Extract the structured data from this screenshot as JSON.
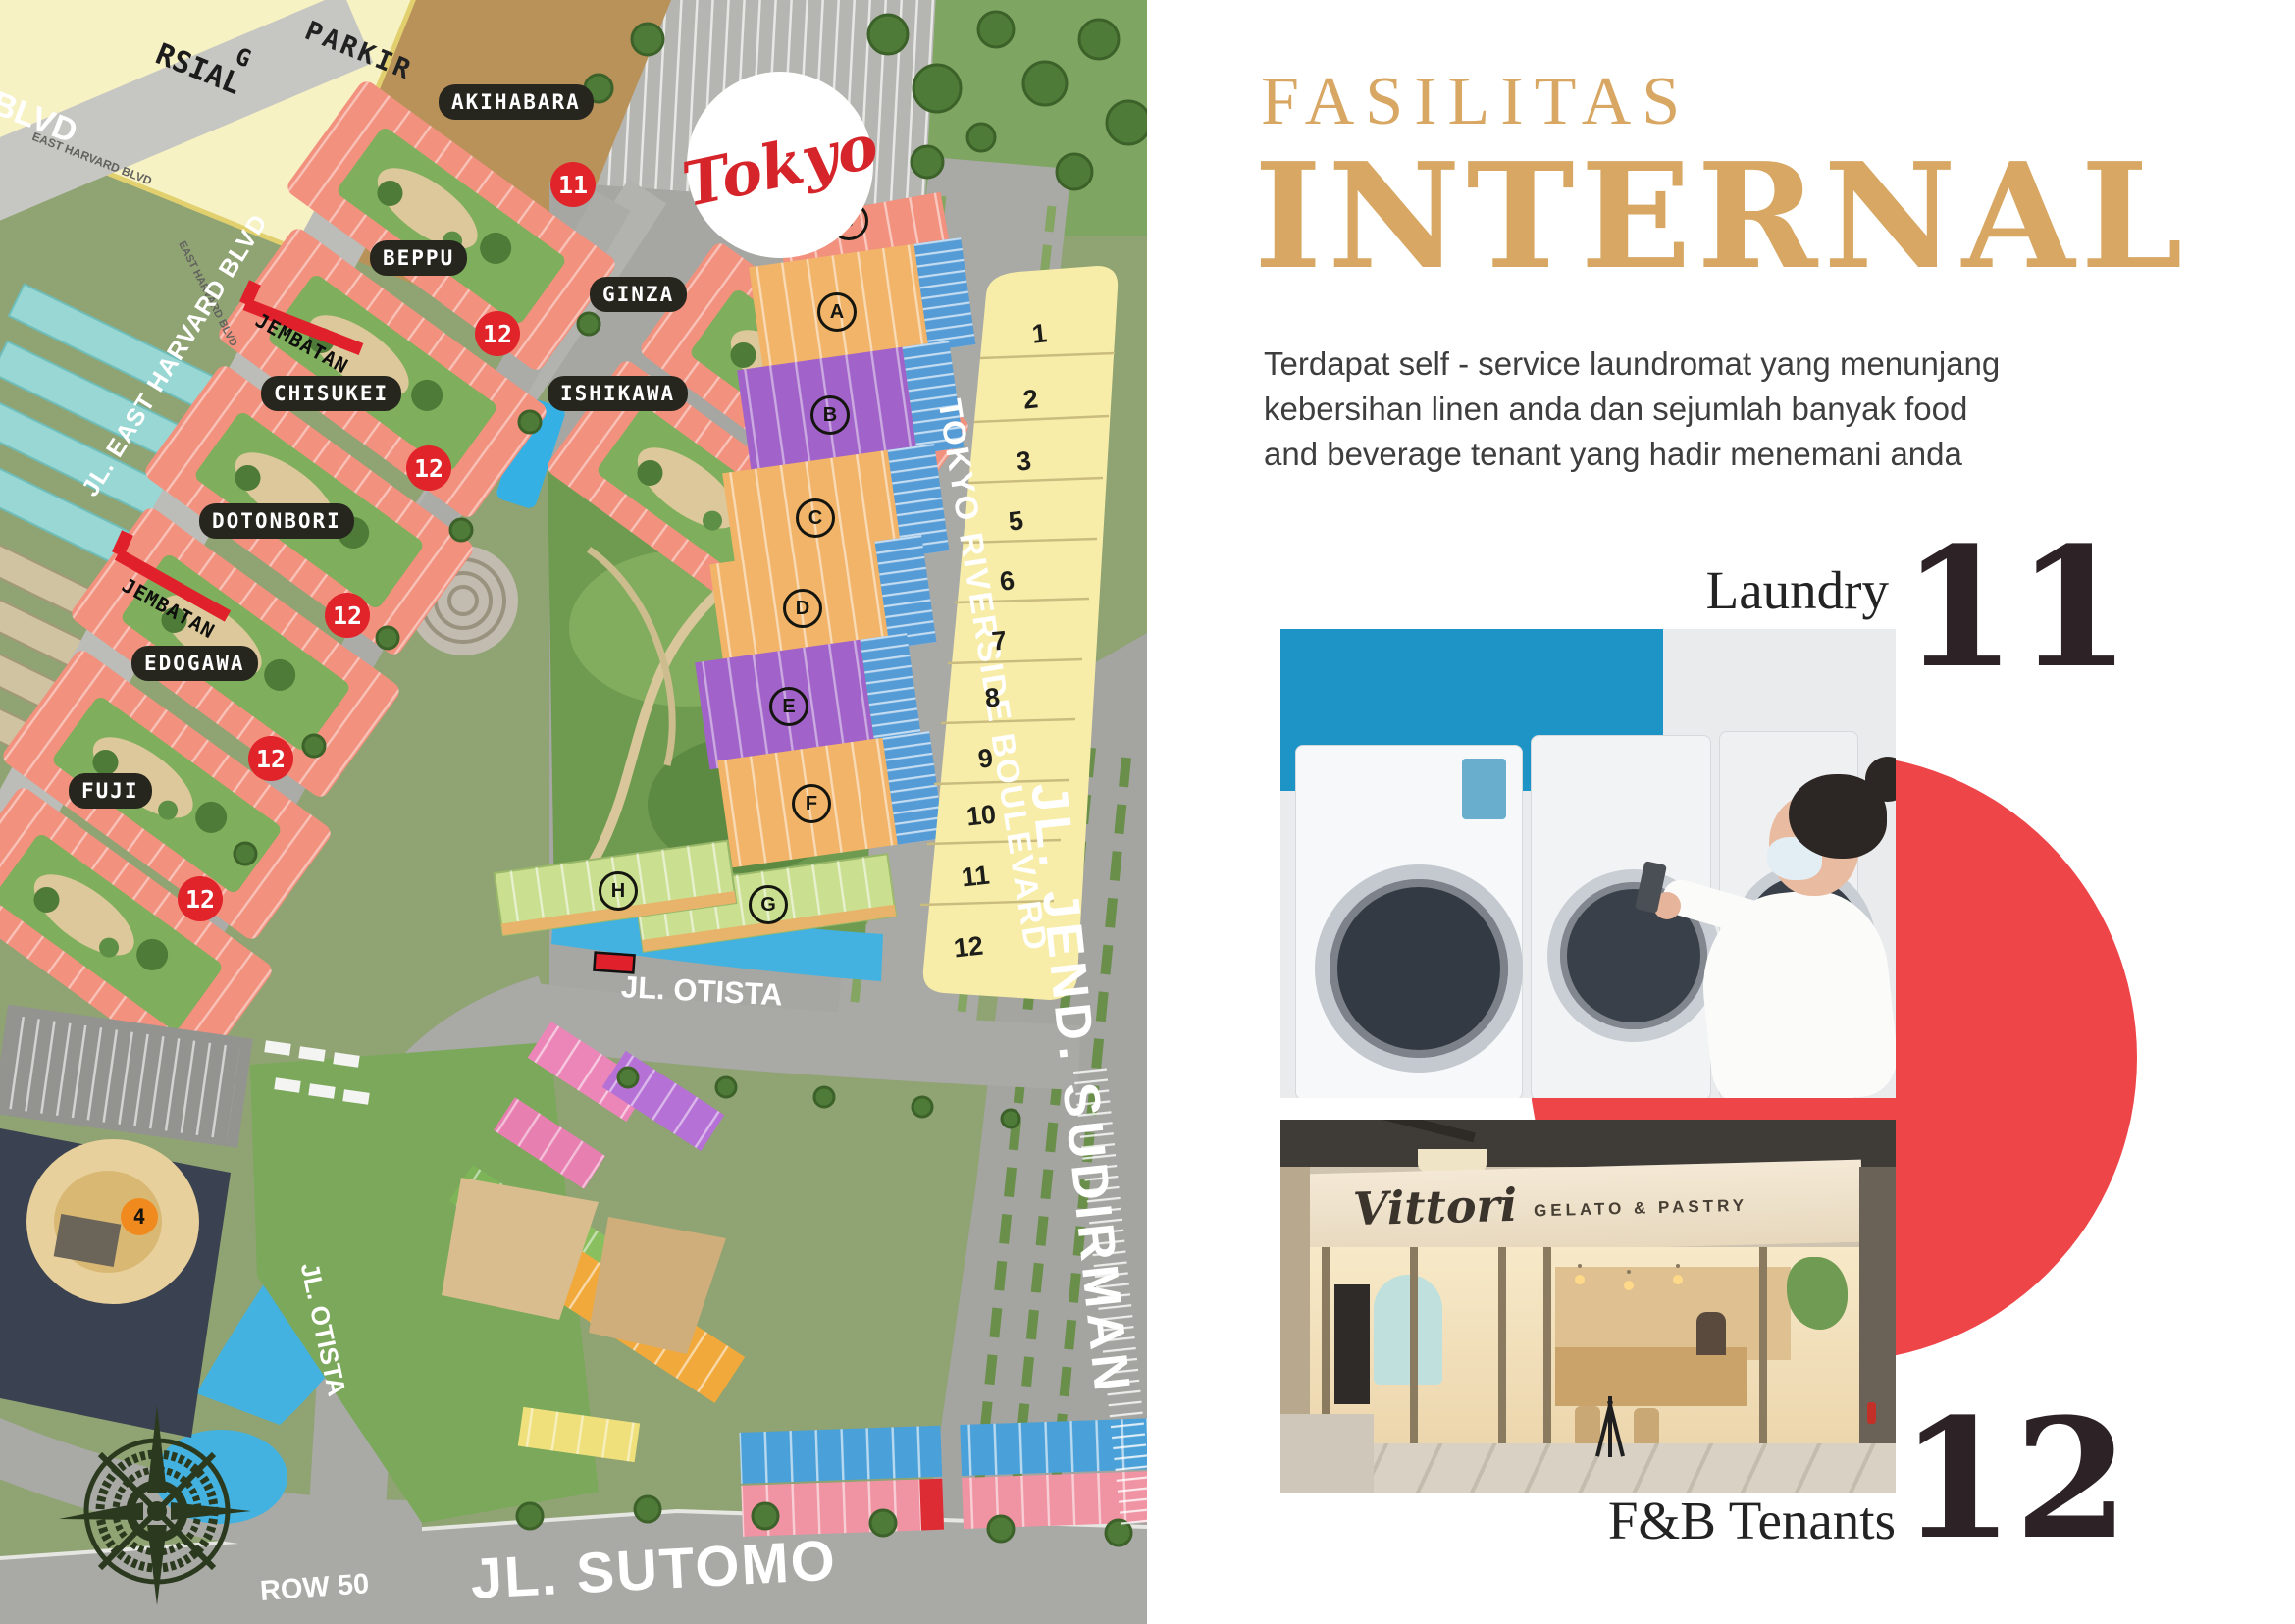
{
  "map": {
    "logo_text": "Tokyo",
    "commercial_fragments": [
      "G",
      "RSIAL"
    ],
    "parking_label": "PARKIR",
    "road_labels": {
      "blvd_corner": "BLVD",
      "east_harvard_small_1": "EAST HARVARD BLVD",
      "east_harvard_small_2": "EAST HARVARD BLVD",
      "east_harvard_main": "JL. EAST HARVARD BLVD",
      "riverside_blvd": "TOKYO RIVERSIDE BOULEVARD",
      "sudirman": "JL. JEND. SUDIRMAN",
      "otista_h": "JL. OTISTA",
      "otista_v": "JL. OTISTA",
      "sutomo": "JL. SUTOMO",
      "row50": "ROW 50"
    },
    "clusters": [
      "AKIHABARA",
      "BEPPU",
      "GINZA",
      "CHISUKEI",
      "ISHIKAWA",
      "DOTONBORI",
      "EDOGAWA",
      "FUJI"
    ],
    "bridges": [
      "JEMBATAN",
      "JEMBATAN"
    ],
    "badges": [
      "11",
      "12",
      "12",
      "12",
      "12",
      "12",
      "4"
    ],
    "lot_numbers": [
      "1",
      "2",
      "3",
      "5",
      "6",
      "7",
      "8",
      "9",
      "10",
      "11",
      "12"
    ],
    "block_letters": [
      "J",
      "A",
      "B",
      "C",
      "D",
      "E",
      "F",
      "H",
      "G"
    ]
  },
  "panel": {
    "title_line1": "FASILITAS",
    "title_line2": "INTERNAL",
    "description_lines": [
      "Terdapat self - service laundromat yang menunjang",
      "kebersihan linen anda dan  sejumlah banyak food",
      "and beverage tenant yang hadir menemani anda"
    ],
    "laundry": {
      "label": "Laundry",
      "number": "11"
    },
    "fnb": {
      "label": "F&B Tenants",
      "number": "12"
    },
    "vittori_sign": {
      "name": "Vittori",
      "sub": "GELATO & PASTRY"
    },
    "colors": {
      "accent_gold": "#d7a763",
      "accent_red": "#ee4549",
      "number_dark": "#2d2327",
      "badge_red": "#e1232a",
      "badge_orange": "#f08a1e"
    }
  }
}
